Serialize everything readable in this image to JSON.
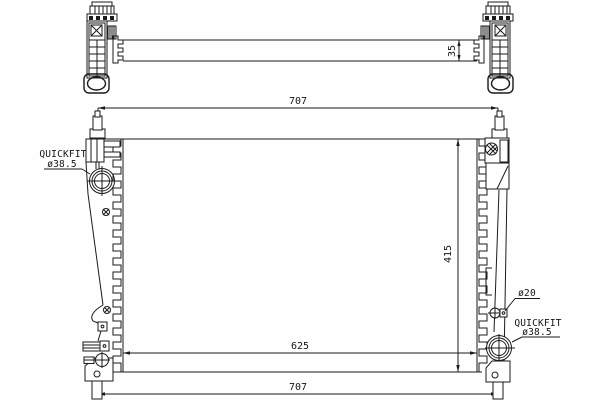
{
  "drawing": {
    "type": "radiator-technical-drawing",
    "colors": {
      "background": "#fefefe",
      "line": "#1b1b1b"
    },
    "dimensions": {
      "top_width": "707",
      "core_depth": "35",
      "height": "415",
      "core_width": "625",
      "bottom_width": "707"
    },
    "labels": {
      "left_quickfit_line1": "QUICKFIT",
      "left_quickfit_line2": "ø38.5",
      "right_small_port": "ø20",
      "right_quickfit_line1": "QUICKFIT",
      "right_quickfit_line2": "ø38.5"
    }
  }
}
